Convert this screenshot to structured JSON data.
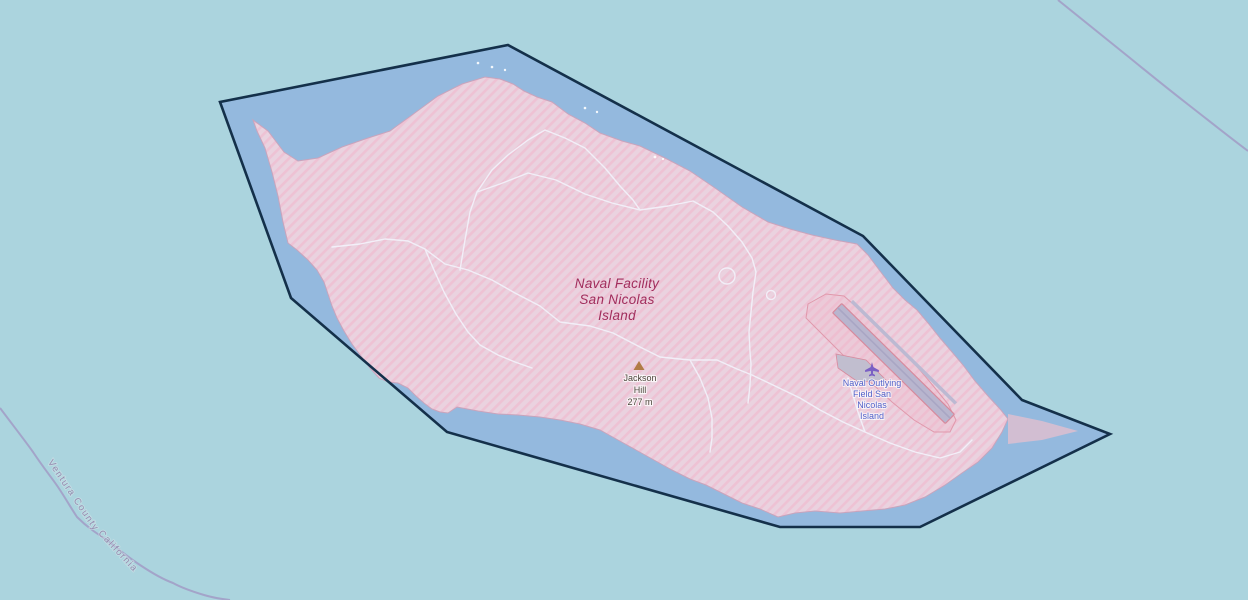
{
  "map": {
    "description": "OpenStreetMap-style view of San Nicolas Island with selected military boundary polygon",
    "labels": {
      "military_area": {
        "lines": [
          "Naval Facility",
          "San Nicolas",
          "Island"
        ],
        "color": "#a12d5c"
      },
      "peak": {
        "name_line1": "Jackson",
        "name_line2": "Hill",
        "elevation": "277 m",
        "text_color": "#4d463c",
        "marker_icon": "peak-triangle-icon",
        "marker_color": "#b07c45"
      },
      "airfield": {
        "lines": [
          "Naval Outlying",
          "Field San",
          "Nicolas",
          "Island"
        ],
        "color": "#5262c9",
        "icon": "airplane-icon",
        "icon_color": "#7a5fc4"
      },
      "admin": {
        "county": "Ventura County",
        "state": "California",
        "color": "#968cb0"
      }
    },
    "colors": {
      "ocean": "#abd4de",
      "selection_water": "#94b9de",
      "selection_border": "#14304a",
      "island_fill": "#ead2df",
      "island_hatch": "#eec2d4",
      "coastline": "#c9a4bc",
      "road": "#f3f2fb",
      "runway_fill": "#b8b5ce",
      "runway_border": "#d78a9d",
      "admin_line": "#a29ec6"
    }
  }
}
